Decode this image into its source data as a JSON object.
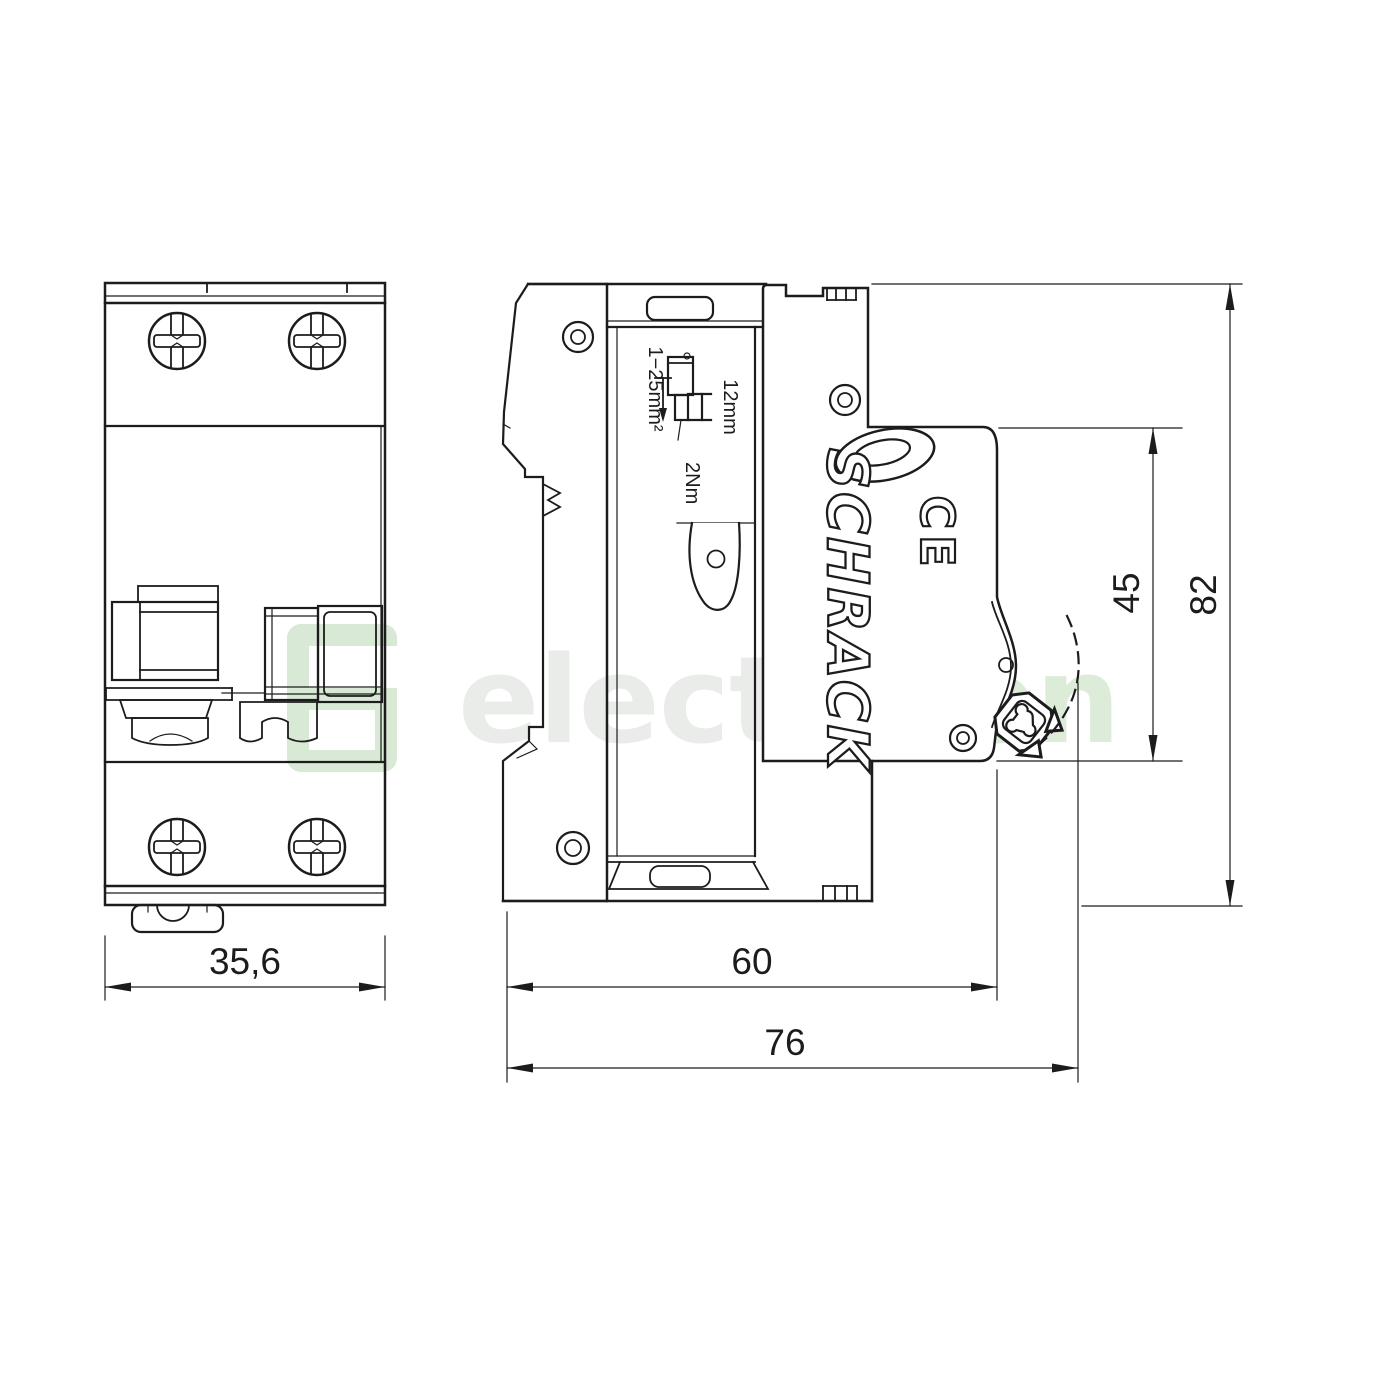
{
  "page": {
    "background_color": "#ffffff",
    "line_color": "#1c1c1c"
  },
  "watermark": {
    "text_part1": "electr",
    "text_part2": "icon",
    "color_part1": "#e9ece9",
    "color_part2": "#dcecd9",
    "logo_color": "#d8ead5"
  },
  "branding": {
    "manufacturer": "SCHRACK",
    "ce_mark": "CE"
  },
  "annotations": {
    "wire_range": "1−25mm²",
    "strip_length": "12mm",
    "torque": "2Nm"
  },
  "dimensions": {
    "front_width": {
      "value": "35,6"
    },
    "body_depth": {
      "value": "60"
    },
    "total_depth": {
      "value": "76"
    },
    "handle_height": {
      "value": "45"
    },
    "total_height": {
      "value": "82"
    }
  }
}
